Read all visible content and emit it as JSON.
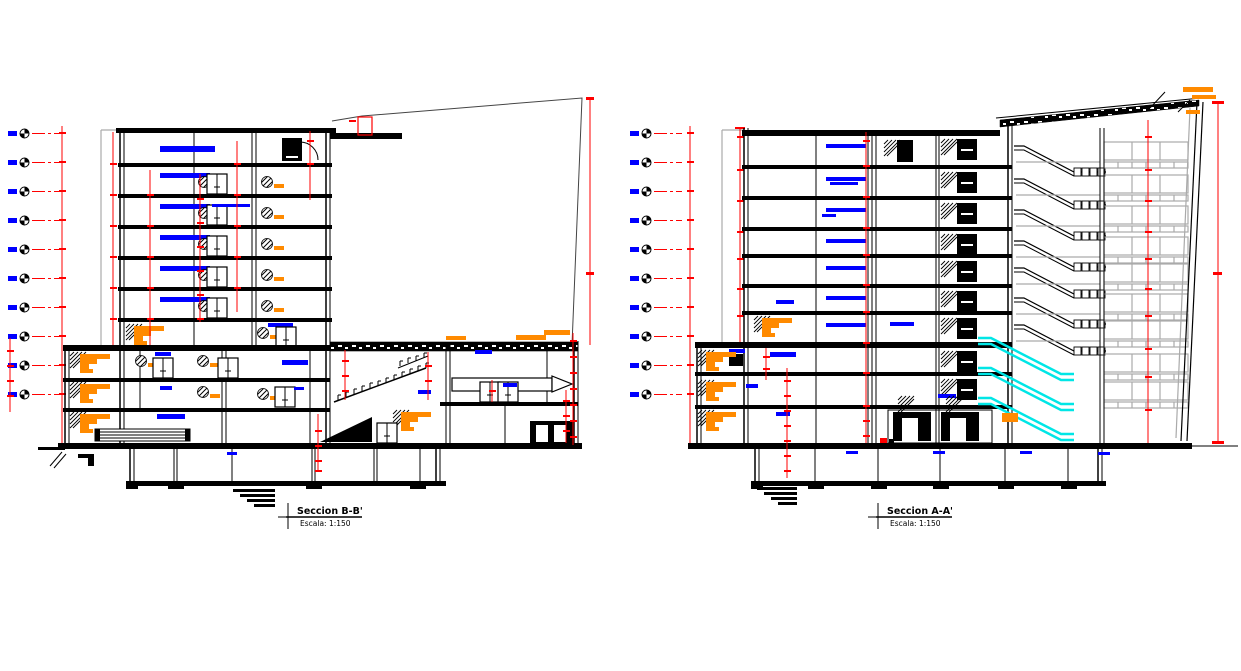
{
  "palette": {
    "bg": "#ffffff",
    "ink": "#000000",
    "red": "#ff0000",
    "blue": "#0000ff",
    "orange": "#ff8a00",
    "cyan": "#00e6e6",
    "gray": "#444444",
    "lightgray": "#aaaaaa"
  },
  "sections": {
    "left": {
      "title": "Seccion B-B'",
      "scale_label": "Escala: 1:150",
      "level_markers": 10,
      "escalators": 0
    },
    "right": {
      "title": "Seccion A-A'",
      "scale_label": "Escala: 1:150",
      "level_markers": 10,
      "escalators": 3
    }
  }
}
